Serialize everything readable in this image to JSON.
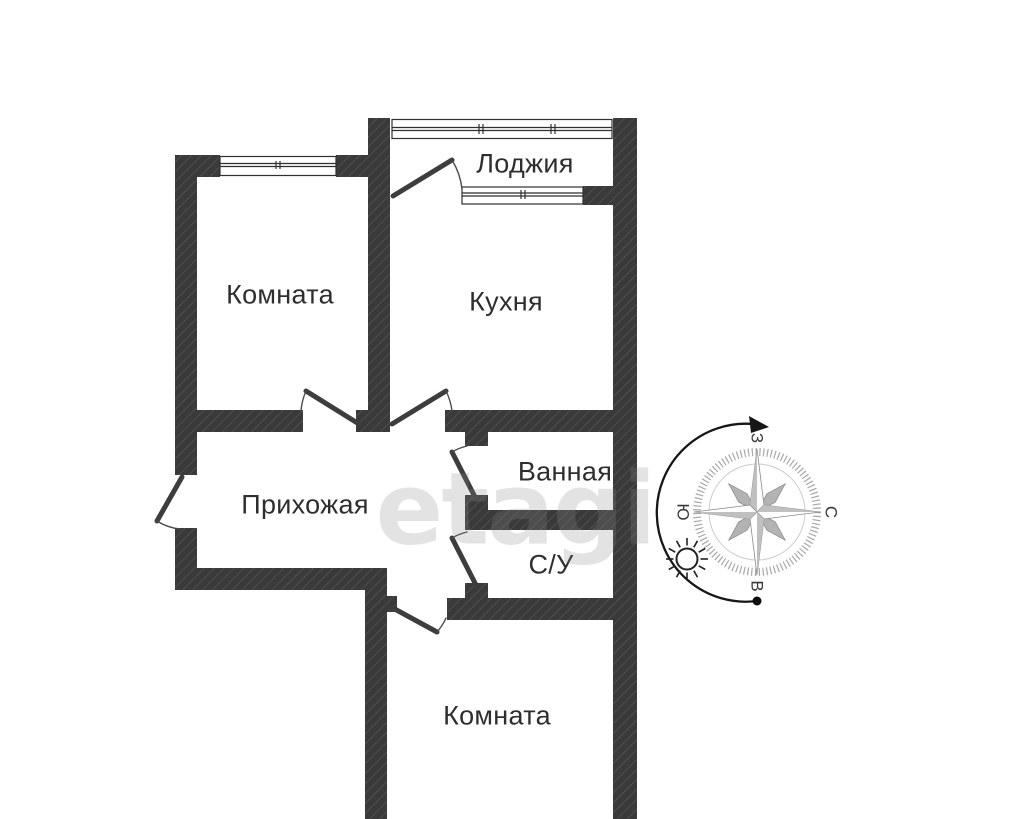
{
  "watermark": {
    "text": "etagi"
  },
  "rooms": [
    {
      "id": "loggia",
      "label": "Лоджия"
    },
    {
      "id": "room-top",
      "label": "Комната"
    },
    {
      "id": "kitchen",
      "label": "Кухня"
    },
    {
      "id": "bathroom",
      "label": "Ванная"
    },
    {
      "id": "hallway",
      "label": "Прихожая"
    },
    {
      "id": "wc",
      "label": "С/У"
    },
    {
      "id": "room-bottom",
      "label": "Комната"
    }
  ],
  "compass": {
    "top": "З",
    "right": "С",
    "bottom": "В",
    "left": "Ю"
  },
  "colors": {
    "wall": "#3a3a3a",
    "hatch": "#5a5a5a",
    "label_text": "#2e2e2e",
    "watermark": "#8c8c8c"
  }
}
